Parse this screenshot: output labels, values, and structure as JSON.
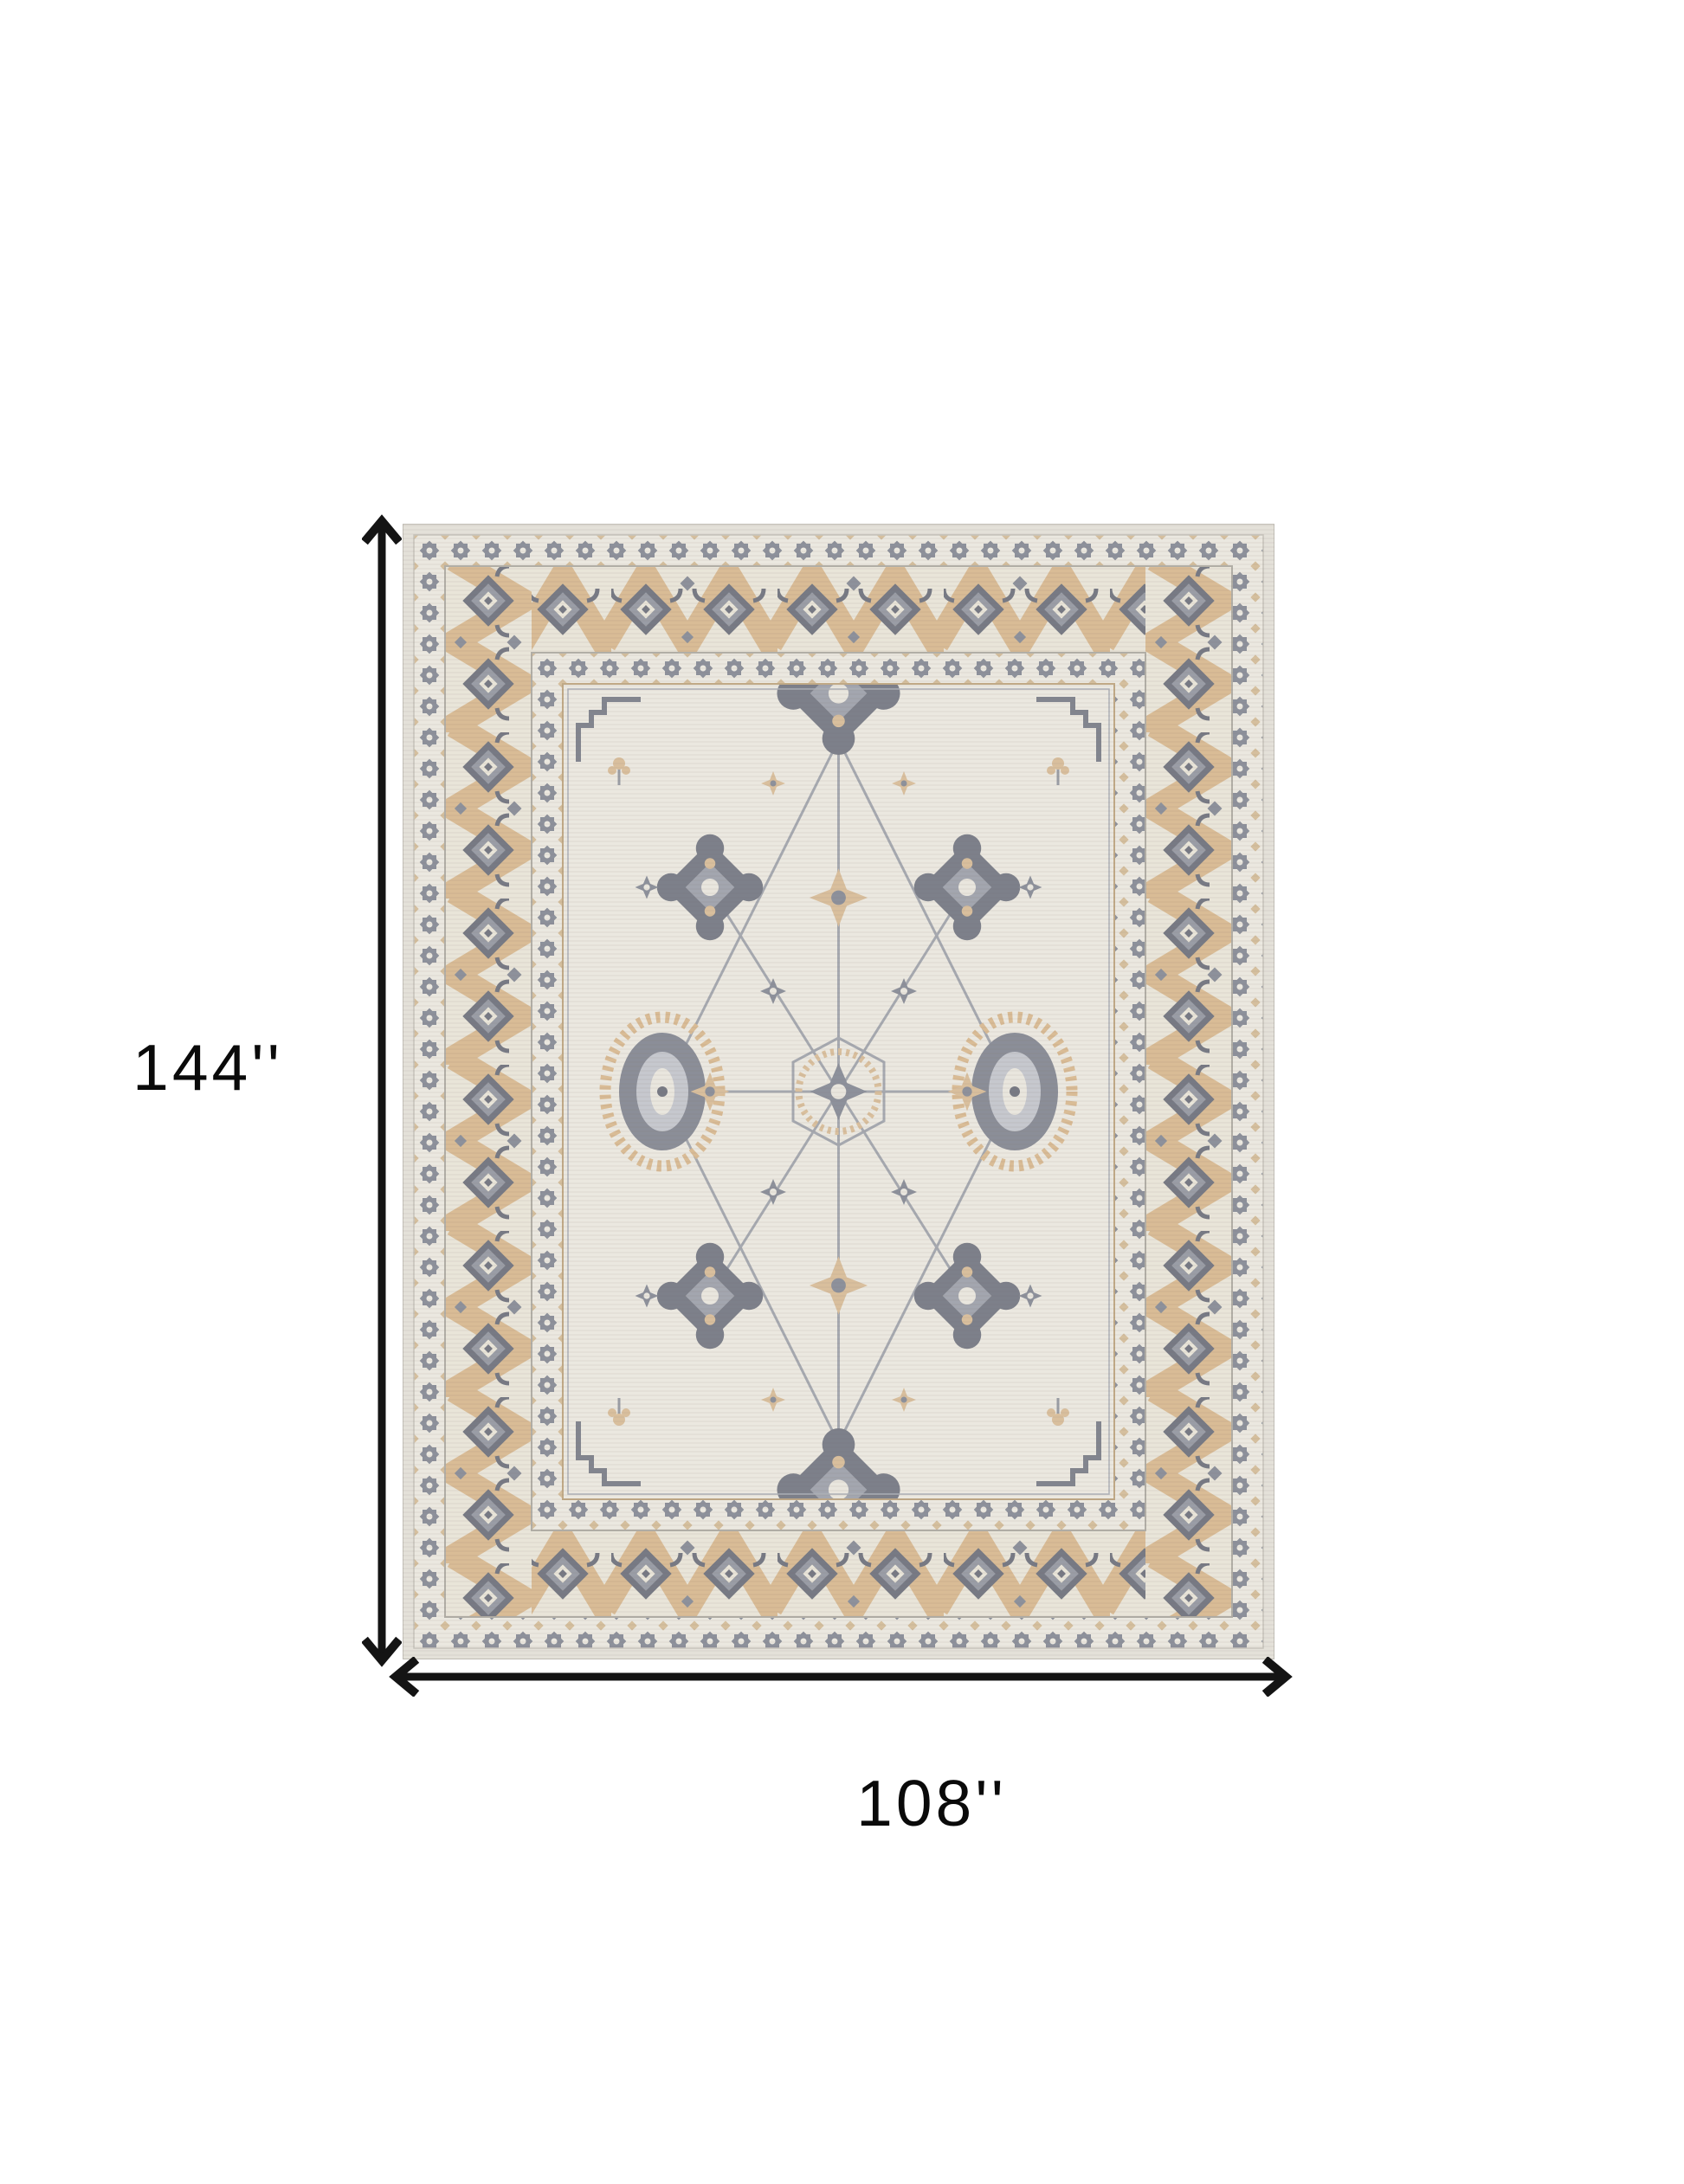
{
  "page": {
    "background_color": "#ffffff",
    "content": "top-down view of a bordered oriental-style area rug with dimension arrows"
  },
  "dimensions": {
    "height": {
      "label": "144''",
      "value": 144,
      "unit": "inches"
    },
    "width": {
      "label": "108''",
      "value": 108,
      "unit": "inches"
    }
  },
  "annotation": {
    "arrow_color": "#141414",
    "label_color": "#0a0a0a"
  },
  "icons": {
    "height_arrow": "vertical-double-headed-dimension-arrow",
    "width_arrow": "horizontal-double-headed-dimension-arrow"
  },
  "rug_palette": {
    "ivory_field": "#ebe8e0",
    "selvage": "#e4e1d9",
    "border_ivory": "#e9e5d9",
    "tan_zigzag": "#d9bc96",
    "tan_light": "#d9bf9d",
    "gray_motif": "#8d919b",
    "gray_dark": "#777a84",
    "gray_light": "#a3a6af",
    "outline": "#c2bfb7"
  }
}
